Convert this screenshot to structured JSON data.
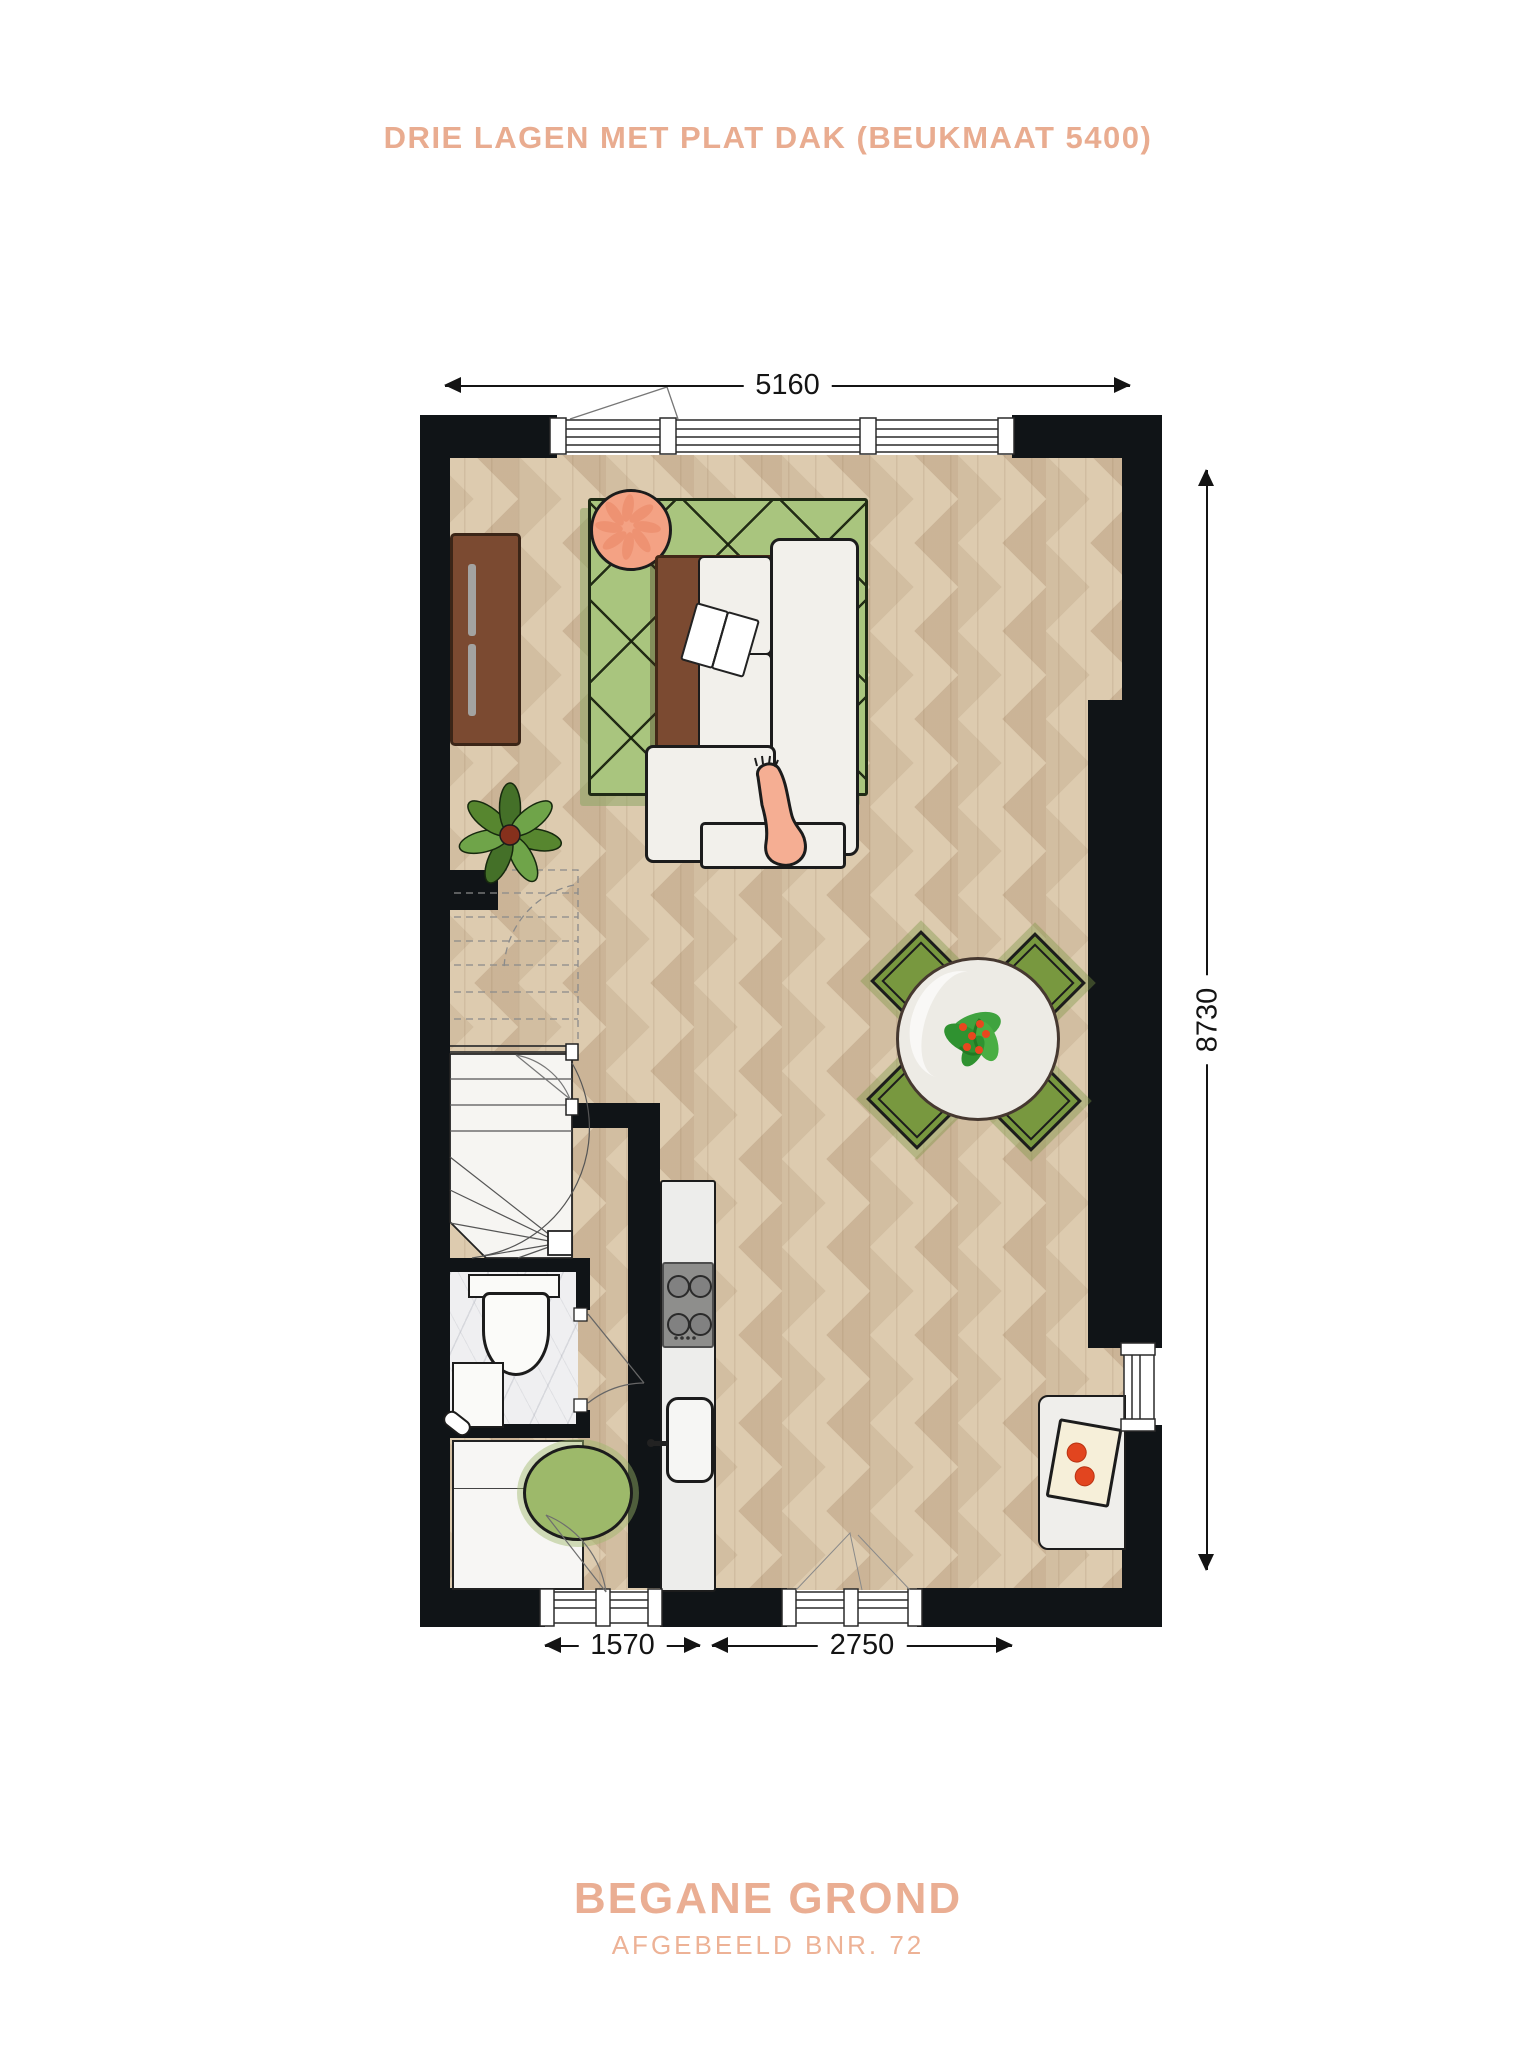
{
  "header": {
    "title": "DRIE LAGEN MET PLAT DAK (BEUKMAAT 5400)"
  },
  "dimensions": {
    "top": "5160",
    "right": "8730",
    "bottom_left": "1570",
    "bottom_right": "2750"
  },
  "footer": {
    "floor_name": "BEGANE GROND",
    "subtitle": "AFGEBEELD BNR. 72"
  },
  "colors": {
    "accent_text": "#E9AC90",
    "wall_black": "#101417",
    "wood_floor": "#DDCBAF",
    "rug_green": "#A9C57E",
    "chair_green": "#78983F",
    "table_brown": "#7B4A31",
    "sofa_white": "#F2F0EB",
    "person_skin": "#F5AE93",
    "pouf_coral": "#F4A284",
    "oval_rug_green": "#9DB96A",
    "marble": "#EFEFF1",
    "stove_gray": "#8E8E8C",
    "tomato_red": "#E2451F",
    "plant_green": "#57862F"
  },
  "floorplan": {
    "rooms": [
      "living-room",
      "dining-area",
      "kitchen",
      "hallway",
      "toilet",
      "staircase"
    ],
    "furniture": [
      "sideboard",
      "round-pouf",
      "area-rug",
      "coffee-table",
      "open-book",
      "corner-sofa",
      "person-legs",
      "potted-plant",
      "dining-table",
      "dining-chairs",
      "kitchen-counter",
      "stove",
      "sink",
      "toilet",
      "washbasin",
      "storage-cabinet",
      "oval-rug",
      "side-counter",
      "cutting-board"
    ]
  }
}
